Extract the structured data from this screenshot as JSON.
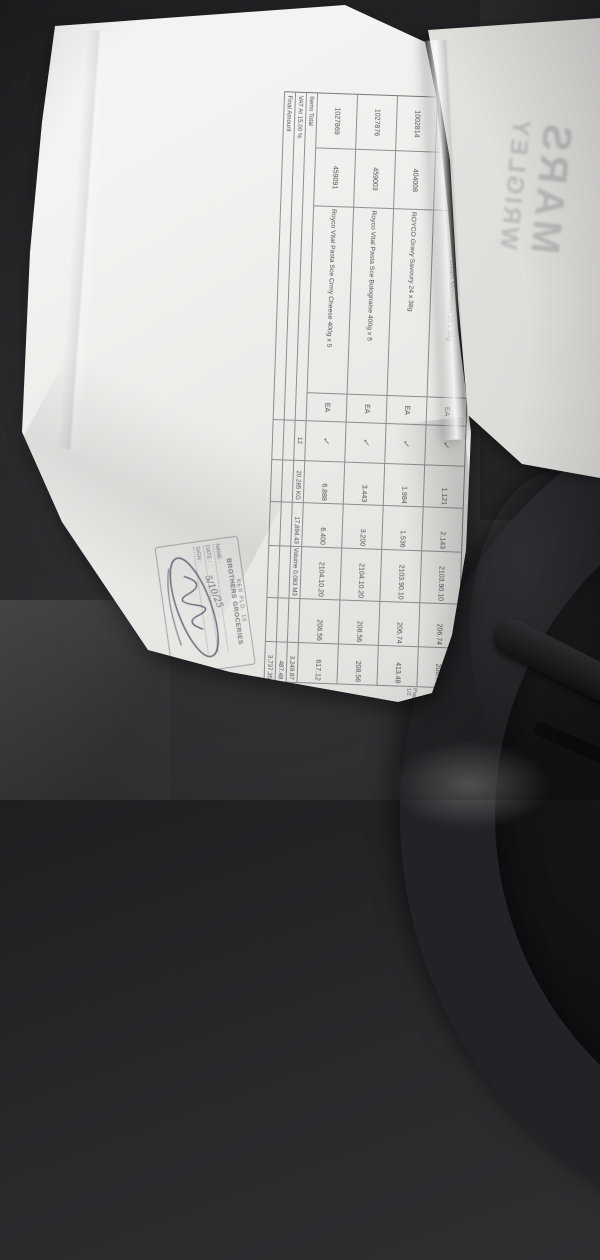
{
  "scene": {
    "background_color": "#2a2a2d",
    "paper_color": "#f1f0ee",
    "print_ink_color": "#3b3b44",
    "stamp_ink_color": "#6c6c7a"
  },
  "overlay_paper": {
    "brand_line1": "MARS",
    "brand_line2": "WRIGLEY"
  },
  "document": {
    "rows": [
      {
        "item_no": "10026164",
        "product_code": "404083",
        "description": "ROYCO Usavi Cream Mushroom 24 x 38g",
        "uom": "EA",
        "qty_mark": "✓",
        "weight": "1.121",
        "units": "2.143",
        "tariff": "2103.90.10",
        "unit_price": "206.74",
        "amount": "206.74"
      },
      {
        "item_no": "1002814",
        "product_code": "404008",
        "description": "ROYCO Gravy Savoury 24 x 38g",
        "uom": "EA",
        "qty_mark": "✓",
        "weight": "1.984",
        "units": "1.536",
        "tariff": "2103.90.10",
        "unit_price": "206.74",
        "amount": "413.48"
      },
      {
        "item_no": "1027876",
        "product_code": "459003",
        "description": "Royco Vital Pasta Sce Bolognaise 400g x 5",
        "uom": "EA",
        "qty_mark": "✓",
        "weight": "3.443",
        "units": "3.200",
        "tariff": "2104.10.20",
        "unit_price": "208.56",
        "amount": "208.56"
      },
      {
        "item_no": "1027869",
        "product_code": "459091",
        "description": "Royco Vital Pasta Sce Crmy Cheese 400g x 5",
        "uom": "EA",
        "qty_mark": "✓",
        "weight": "6.888",
        "units": "6.400",
        "tariff": "2104.10.20",
        "unit_price": "208.56",
        "amount": "617.12"
      }
    ],
    "totals": {
      "items_label": "Items Total",
      "items_qty": "12",
      "items_weight": "20.285 KG",
      "items_misc": "17,894.43",
      "items_volume": "Volume 0.083 M3",
      "items_amount": "3,249.87",
      "vat_label": "VAT At 15.00 %",
      "vat_amount": "487.48",
      "final_label": "Final Amount",
      "final_amount": "3,737.35"
    },
    "page_footer": "Page 1/2"
  },
  "stamp": {
    "line1": "KER PLD. 10",
    "line2": "BROTHERS GROCERIES",
    "name_label": "NAME :",
    "date_label": "DATE :",
    "sign_label": "SIGN :",
    "date_value": "5/10/25"
  }
}
